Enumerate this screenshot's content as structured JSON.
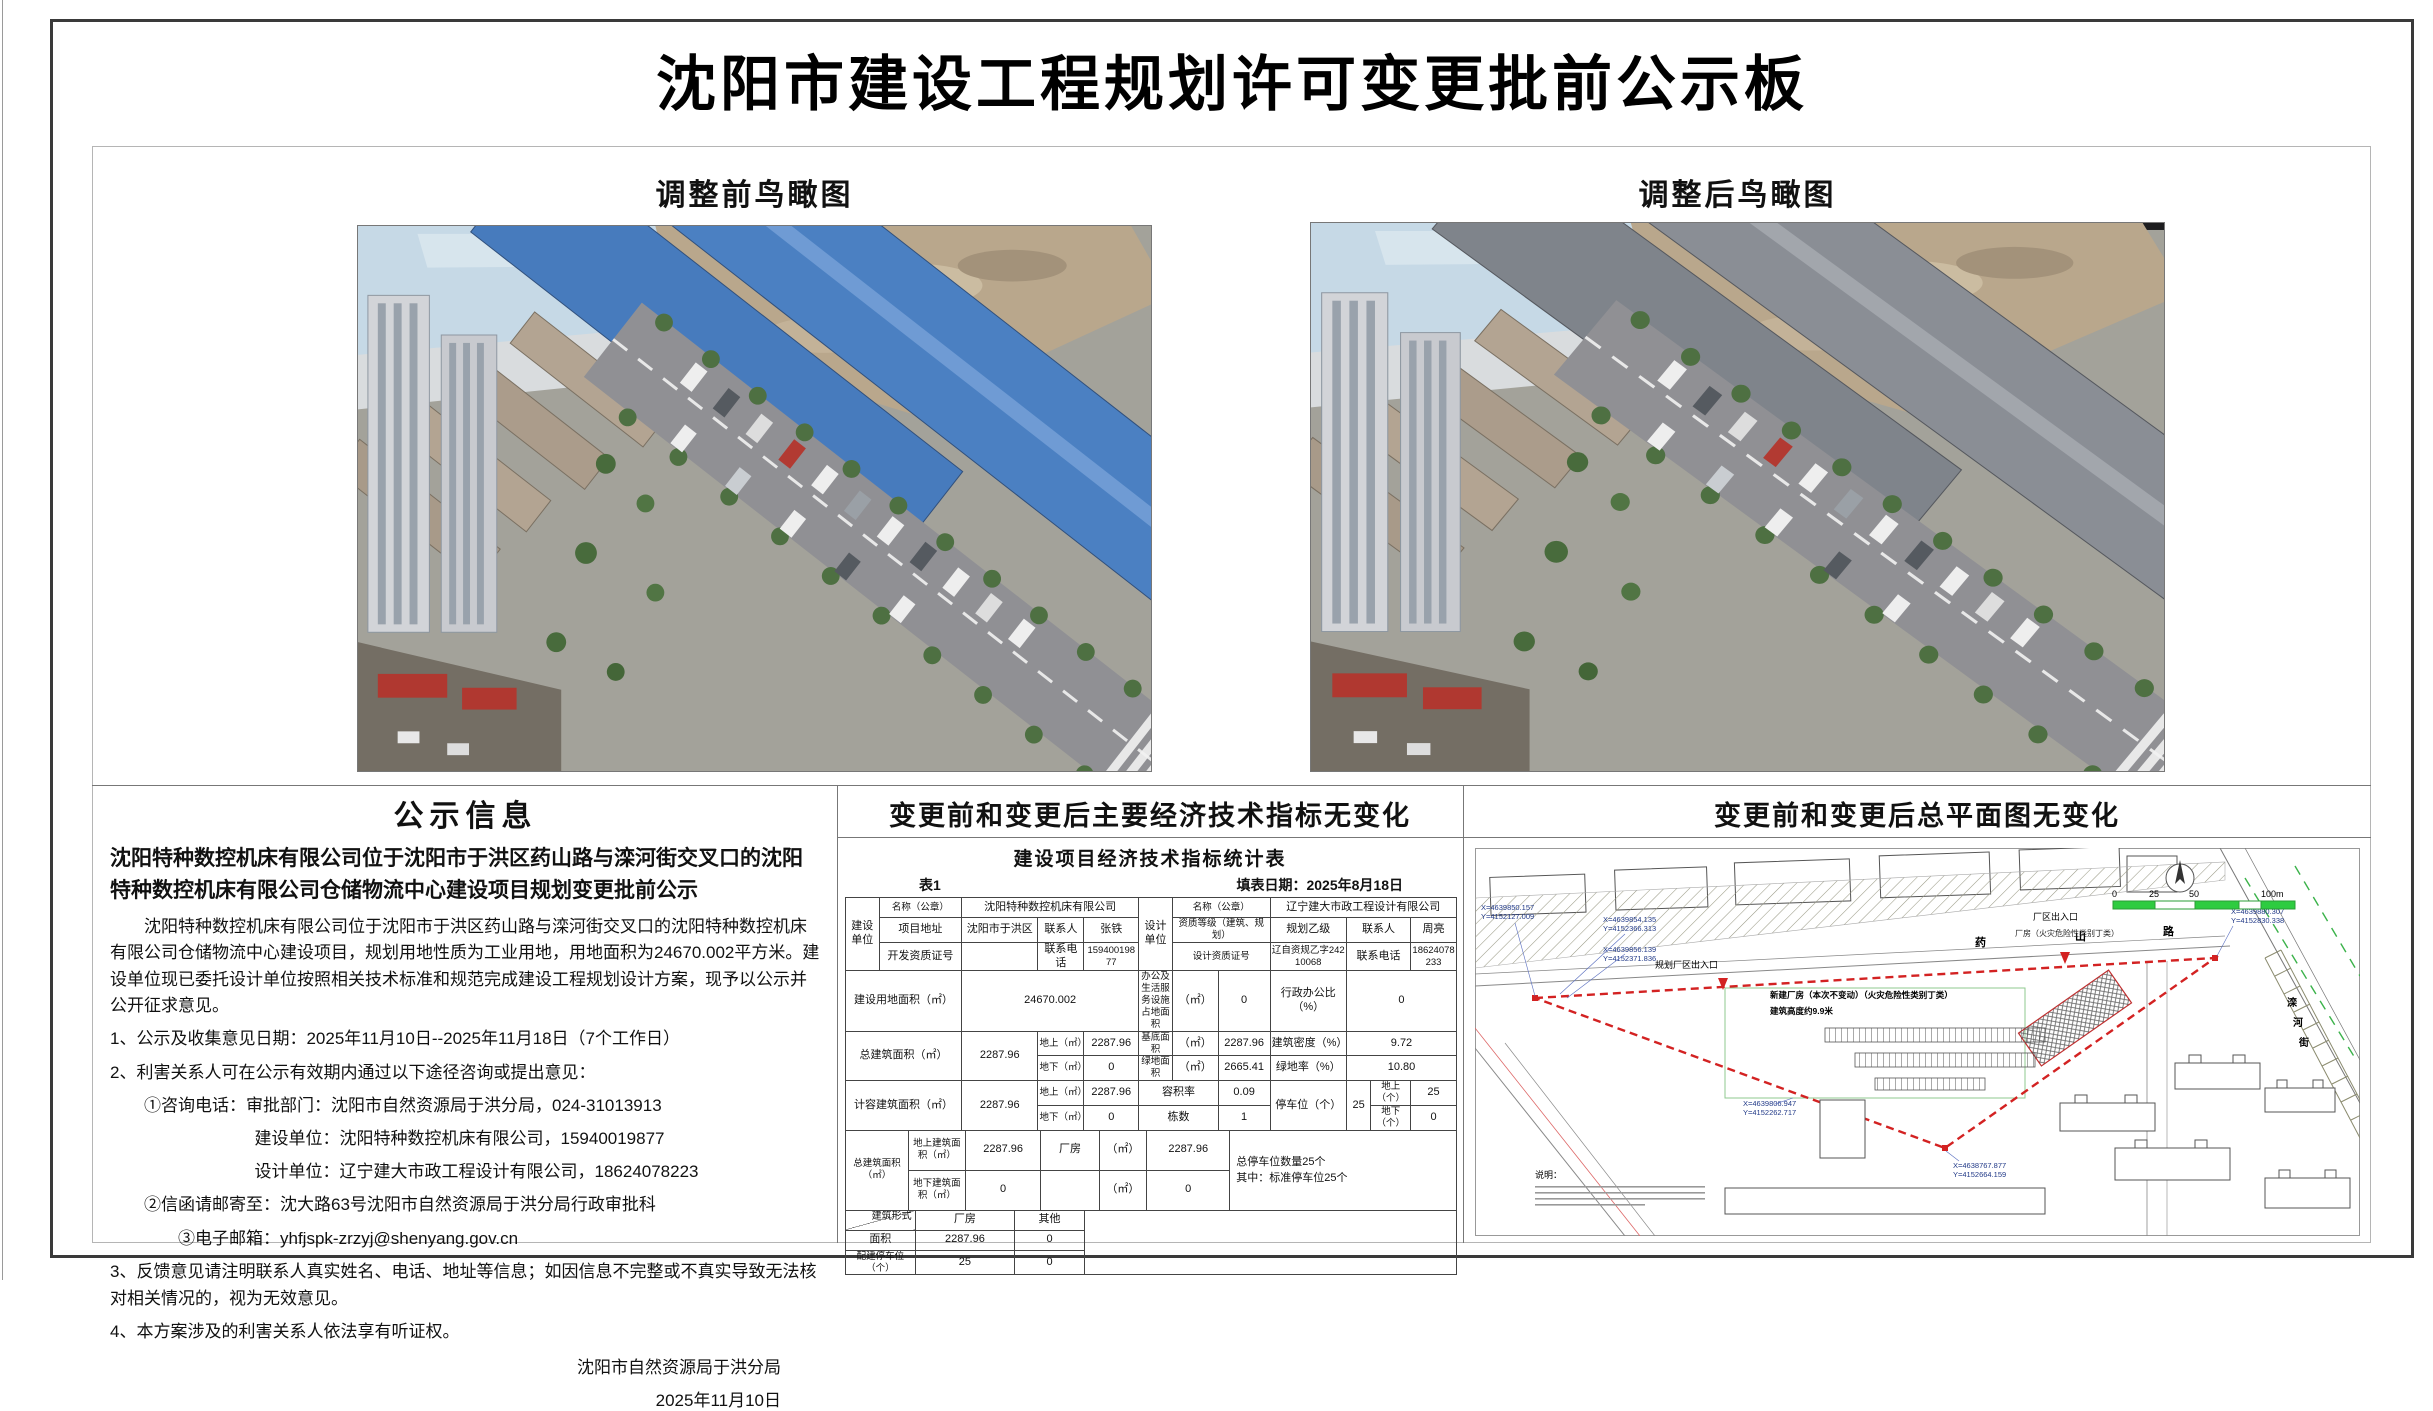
{
  "page": {
    "title": "沈阳市建设工程规划许可变更批前公示板"
  },
  "views": {
    "before_label": "调整前鸟瞰图",
    "after_label": "调整后鸟瞰图",
    "before_roof_main": "#4b80c2",
    "before_roof_ridge": "#6f9bd4",
    "before_roof2": "#477bbd",
    "after_roof_main": "#8a8e95",
    "after_roof_ridge": "#a2a6ac",
    "after_roof2": "#7f848b"
  },
  "notice": {
    "header": "公示信息",
    "bold_title": "沈阳特种数控机床有限公司位于沈阳市于洪区药山路与滦河街交叉口的沈阳特种数控机床有限公司仓储物流中心建设项目规划变更批前公示",
    "paragraph": "沈阳特种数控机床有限公司位于沈阳市于洪区药山路与滦河街交叉口的沈阳特种数控机床有限公司仓储物流中心建设项目，规划用地性质为工业用地，用地面积为24670.002平方米。建设单位现已委托设计单位按照相关技术标准和规范完成建设工程规划设计方案，现予以公示并公开征求意见。",
    "item1": "1、公示及收集意见日期：2025年11月10日--2025年11月18日（7个工作日）",
    "item2": "2、利害关系人可在公示有效期内通过以下途径咨询或提出意见：",
    "phone_line": "①咨询电话：审批部门：沈阳市自然资源局于洪分局，024-31013913",
    "builder_line": "建设单位：沈阳特种数控机床有限公司，15940019877",
    "designer_line": "设计单位：辽宁建大市政工程设计有限公司，18624078223",
    "mail_line": "②信函请邮寄至：沈大路63号沈阳市自然资源局于洪分局行政审批科",
    "email_line": "③电子邮箱：yhfjspk-zrzyj@shenyang.gov.cn",
    "item3": "3、反馈意见请注明联系人真实姓名、电话、地址等信息；如因信息不完整或不真实导致无法核对相关情况的，视为无效意见。",
    "item4": "4、本方案涉及的利害关系人依法享有听证权。",
    "signature": "沈阳市自然资源局于洪分局",
    "date": "2025年11月10日"
  },
  "indicators": {
    "header": "变更前和变更后主要经济技术指标无变化",
    "table_title": "建设项目经济技术指标统计表",
    "table_no": "表1",
    "fill_date": "填表日期：2025年8月18日",
    "cells": {
      "rot_build": "建设单位",
      "rot_design": "设计单位",
      "name_label": "名称（公章）",
      "build_name": "沈阳特种数控机床有限公司",
      "design_name": "辽宁建大市政工程设计有限公司",
      "addr_label": "项目地址",
      "addr": "沈阳市于洪区",
      "contact_label": "联系人",
      "build_contact": "张铁",
      "qual_label": "资质等级（建筑、规划）",
      "qual": "规划乙级",
      "design_contact": "周亮",
      "dev_cert_label": "开发资质证号",
      "phone_label": "联系电话",
      "build_phone": "15940019877",
      "design_cert_label": "设计资质证号",
      "design_cert": "辽自资规乙字24210068",
      "design_phone": "18624078233",
      "land_label": "建设用地面积（㎡）",
      "land": "24670.002",
      "office_label": "办公及生活服务设施占地面积",
      "sqm": "（㎡）",
      "office_val": "0",
      "admin_label": "行政办公比（%）",
      "admin_val": "0",
      "total_label": "总建筑面积（㎡）",
      "total_val": "2287.96",
      "above_label": "地上（㎡）",
      "above_val": "2287.96",
      "below_label": "地下（㎡）",
      "below_val": "0",
      "base_label": "基底面积",
      "base_val": "2287.96",
      "density_label": "建筑密度（%）",
      "density_val": "9.72",
      "green_label": "绿地面积",
      "green_val": "2665.41",
      "green_rate_label": "绿地率（%）",
      "green_rate_val": "10.80",
      "cap_label": "计容建筑面积（㎡）",
      "cap_val": "2287.96",
      "far_label": "容积率",
      "far_val": "0.09",
      "count_label": "栋数",
      "count_val": "1",
      "parking_label": "停车位（个）",
      "parking_val": "25",
      "p_above_label": "地上（个）",
      "p_above_val": "25",
      "p_below_label": "地下（个）",
      "p_below_val": "0",
      "total2_label": "总建筑面积（㎡）",
      "above_area_label": "地上建筑面积（㎡）",
      "above_area_val": "2287.96",
      "factory_label": "厂房",
      "factory_val": "2287.96",
      "parking_note1": "总停车位数量25个",
      "parking_note2": "其中：标准停车位25个",
      "below_area_label": "地下建筑面积（㎡）",
      "below_area_val": "0",
      "form_label": "建筑形式",
      "area_label": "面积",
      "other_label": "其他",
      "form_factory_area": "2287.96",
      "form_other_area": "0",
      "allot_label": "配建停车位（个）",
      "allot_factory": "25",
      "allot_other": "0"
    }
  },
  "siteplan": {
    "header": "变更前和变更后总平面图无变化",
    "road_top_1": "药",
    "road_top_2": "山",
    "road_top_3": "路",
    "road_right_1": "滦",
    "road_right_2": "河",
    "road_right_3": "街",
    "scale_0": "0",
    "scale_25": "25",
    "scale_50": "50",
    "scale_100": "100m",
    "entrance1": "规划厂区出入口",
    "entrance2": "厂区出入口",
    "factory_tag": "厂房（火灾危险性类别丁类）",
    "factory_note1": "新建厂房（本次不变动）（火灾危险性类别丁类）",
    "factory_note2": "建筑高度约9.9米",
    "note_header": "说明：",
    "coords": [
      {
        "x": "X=4639850.157",
        "y": "Y=4152127.009"
      },
      {
        "x": "X=4639854.135",
        "y": "Y=4152366.313"
      },
      {
        "x": "X=4639856.139",
        "y": "Y=4152371.836"
      },
      {
        "x": "X=4639806.947",
        "y": "Y=4152262.717"
      },
      {
        "x": "X=4638767.877",
        "y": "Y=4152664.159"
      },
      {
        "x": "X=4639880.307",
        "y": "Y=4152830.338"
      }
    ]
  }
}
